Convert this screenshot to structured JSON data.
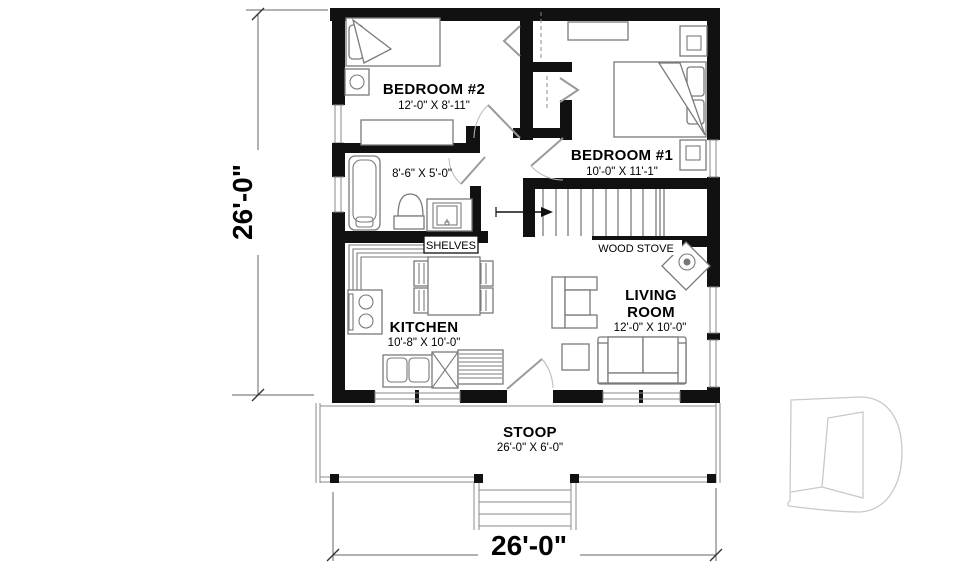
{
  "floor_plan": {
    "rooms": {
      "bedroom2": {
        "name": "BEDROOM #2",
        "size": "12'-0\" X 8'-11\""
      },
      "bedroom1": {
        "name": "BEDROOM #1",
        "size": "10'-0\" X 11'-1\""
      },
      "bathroom": {
        "size": "8'-6\" X 5'-0\""
      },
      "kitchen": {
        "name": "KITCHEN",
        "size": "10'-8\" X 10'-0\""
      },
      "living_room": {
        "name_line1": "LIVING",
        "name_line2": "ROOM",
        "size": "12'-0\" X 10'-0\""
      },
      "stoop": {
        "name": "STOOP",
        "size": "26'-0\" X 6'-0\""
      }
    },
    "annotations": {
      "shelves": "SHELVES",
      "wood_stove": "WOOD STOVE"
    },
    "dimensions": {
      "overall_width": "26'-0\"",
      "overall_depth": "26'-0\""
    },
    "colors": {
      "wall": "#111111",
      "furniture_line": "#7a7a7a",
      "dimension_line": "#666666",
      "logo_outline": "#c9c9c9"
    },
    "logo": "drummond-d-watermark"
  }
}
